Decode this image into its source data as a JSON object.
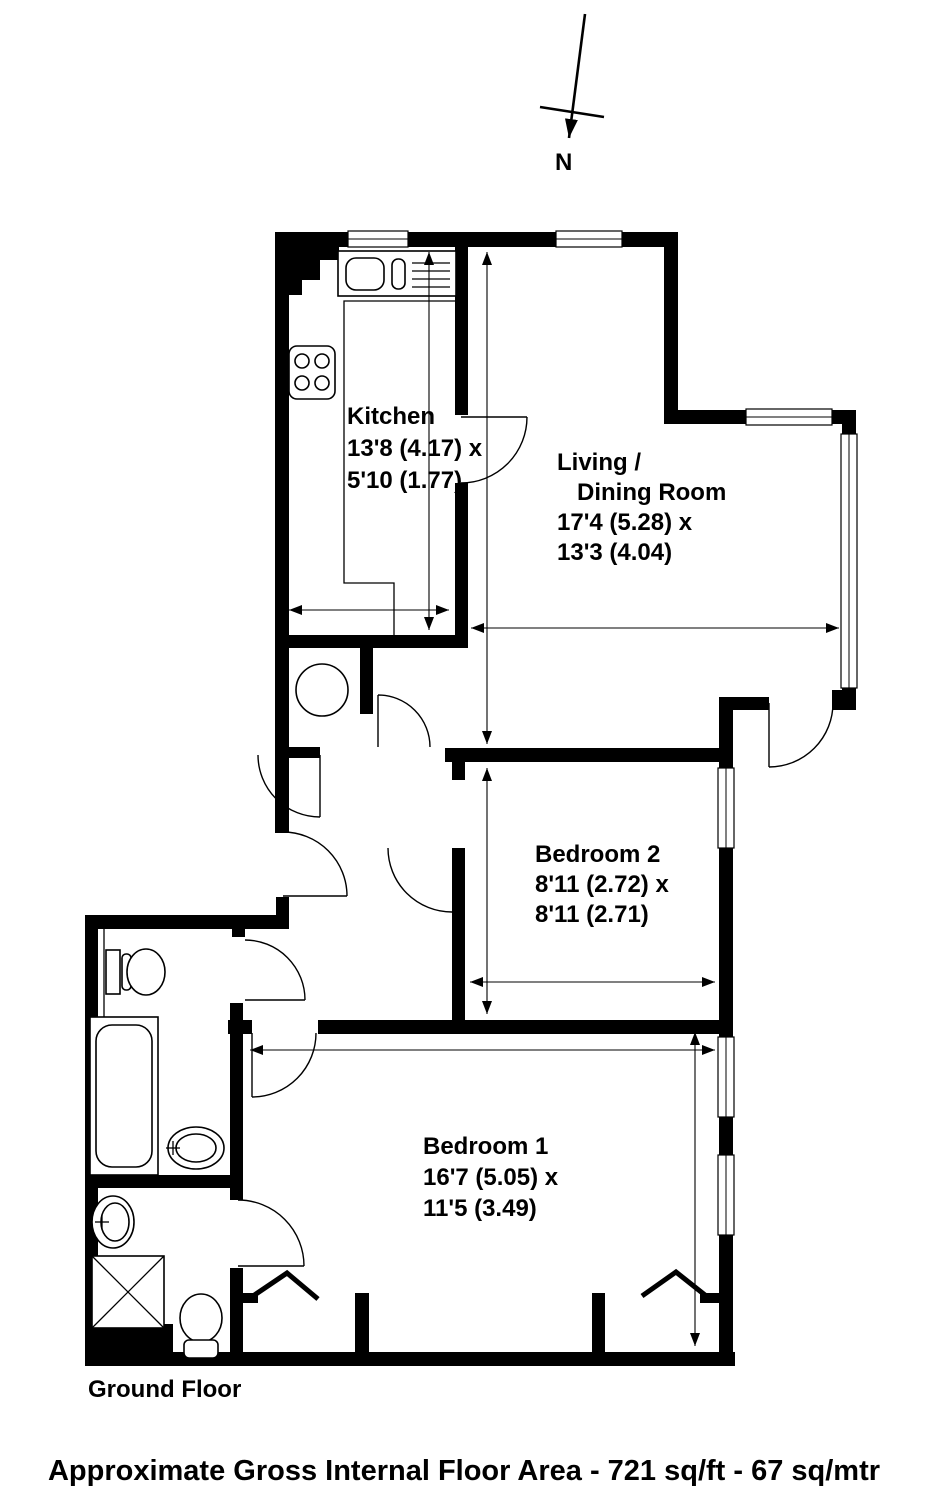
{
  "colors": {
    "ink": "#000000",
    "paper": "#ffffff"
  },
  "compass": {
    "label": "N"
  },
  "rooms": {
    "kitchen": {
      "name": "Kitchen",
      "dims": [
        "13'8 (4.17) x",
        "5'10 (1.77)"
      ]
    },
    "living_dining": {
      "name_lines": [
        "Living /",
        "Dining Room"
      ],
      "dims": [
        "17'4 (5.28) x",
        "13'3 (4.04)"
      ]
    },
    "bedroom2": {
      "name": "Bedroom 2",
      "dims": [
        "8'11 (2.72) x",
        "8'11 (2.71)"
      ]
    },
    "bedroom1": {
      "name": "Bedroom 1",
      "dims": [
        "16'7 (5.05) x",
        "11'5 (3.49)"
      ]
    }
  },
  "floor_label": "Ground Floor",
  "footer": "Approximate Gross Internal Floor Area - 721 sq/ft - 67 sq/mtr"
}
